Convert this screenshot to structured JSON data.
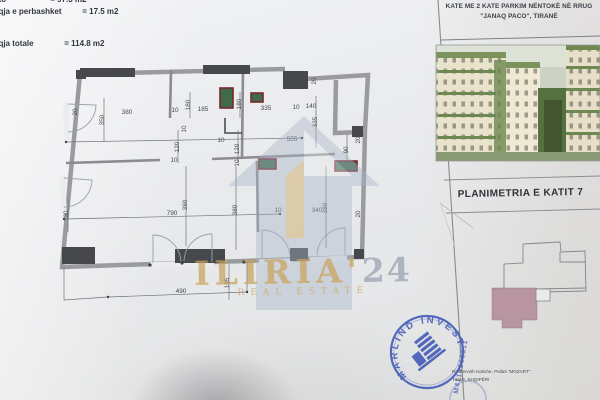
{
  "document": {
    "area_lines": [
      {
        "label": "eto",
        "value": "= 97.3 m2"
      },
      {
        "label": "aqja e perbashket",
        "value": "= 17.5 m2"
      },
      {
        "label": "aqja totale",
        "value": "= 114.8 m2"
      }
    ],
    "header": {
      "line1": "KATE ME 2 KATE PARKIM NËNTOKË NË RRUG",
      "line2": "\"JANAQ PACO\", TIRANË"
    },
    "plan_title": "PLANIMETRIA E KATIT 7",
    "watermark": {
      "brand": "ILIRIA",
      "apostrophe": "'",
      "year": "24",
      "tagline": "REAL ESTATE"
    },
    "stamp": {
      "name": "MARLIND INVEST",
      "code": "M4114280311"
    },
    "address": {
      "line1": "Rr. Dervish Hatixhe, Pallati \"MOZART\"",
      "line2": "Tiranë, SHQIPËRI"
    }
  },
  "floor_plan": {
    "dimensions": [
      {
        "t": "20",
        "x": 77,
        "y": 112,
        "r": -90
      },
      {
        "t": "380",
        "x": 127,
        "y": 114,
        "r": 0
      },
      {
        "t": "350",
        "x": 104,
        "y": 120,
        "r": -90
      },
      {
        "t": "10",
        "x": 175,
        "y": 112,
        "r": 0
      },
      {
        "t": "180",
        "x": 190,
        "y": 105,
        "r": -90
      },
      {
        "t": "185",
        "x": 203,
        "y": 111,
        "r": 0
      },
      {
        "t": "180",
        "x": 241,
        "y": 104,
        "r": -90
      },
      {
        "t": "335",
        "x": 266,
        "y": 110,
        "r": 0
      },
      {
        "t": "10",
        "x": 296,
        "y": 109,
        "r": 0
      },
      {
        "t": "140",
        "x": 311,
        "y": 108,
        "r": 0
      },
      {
        "t": "20",
        "x": 316,
        "y": 81,
        "r": -90
      },
      {
        "t": "335",
        "x": 317,
        "y": 122,
        "r": -90
      },
      {
        "t": "10",
        "x": 186,
        "y": 129,
        "r": -90
      },
      {
        "t": "120",
        "x": 179,
        "y": 147,
        "r": -90
      },
      {
        "t": "10",
        "x": 221,
        "y": 142,
        "r": 0
      },
      {
        "t": "120",
        "x": 239,
        "y": 149,
        "r": -90
      },
      {
        "t": "10",
        "x": 239,
        "y": 163,
        "r": -90
      },
      {
        "t": "10",
        "x": 174,
        "y": 162,
        "r": 0
      },
      {
        "t": "555",
        "x": 292,
        "y": 141,
        "r": 0
      },
      {
        "t": "90",
        "x": 348,
        "y": 150,
        "r": -90
      },
      {
        "t": "20",
        "x": 360,
        "y": 140,
        "r": -90
      },
      {
        "t": "20",
        "x": 360,
        "y": 214,
        "r": -90
      },
      {
        "t": "30",
        "x": 68,
        "y": 214,
        "r": -90
      },
      {
        "t": "380",
        "x": 187,
        "y": 205,
        "r": -90
      },
      {
        "t": "790",
        "x": 172,
        "y": 215,
        "r": 0
      },
      {
        "t": "380",
        "x": 237,
        "y": 210,
        "r": -90
      },
      {
        "t": "10",
        "x": 278,
        "y": 212,
        "r": 0
      },
      {
        "t": "340",
        "x": 317,
        "y": 212,
        "r": 0
      },
      {
        "t": "380",
        "x": 327,
        "y": 208,
        "r": -90
      },
      {
        "t": "490",
        "x": 181,
        "y": 293,
        "r": 0
      },
      {
        "t": "195",
        "x": 229,
        "y": 283,
        "r": -90
      }
    ],
    "windows": [
      {
        "x": 220,
        "y": 88,
        "w": 13,
        "h": 20
      },
      {
        "x": 251,
        "y": 93,
        "w": 12,
        "h": 9
      },
      {
        "x": 259,
        "y": 159,
        "w": 17,
        "h": 10
      },
      {
        "x": 335,
        "y": 161,
        "w": 22,
        "h": 10
      }
    ]
  },
  "colors": {
    "unit_pink": "#b58d9b",
    "stamp_blue": "#3b54b6",
    "gold": "#c9a35c",
    "wall_gray": "#9a9b9e",
    "wall_dark": "#46484c",
    "window_green": "#3f6b4a",
    "window_red": "#7a2630"
  }
}
